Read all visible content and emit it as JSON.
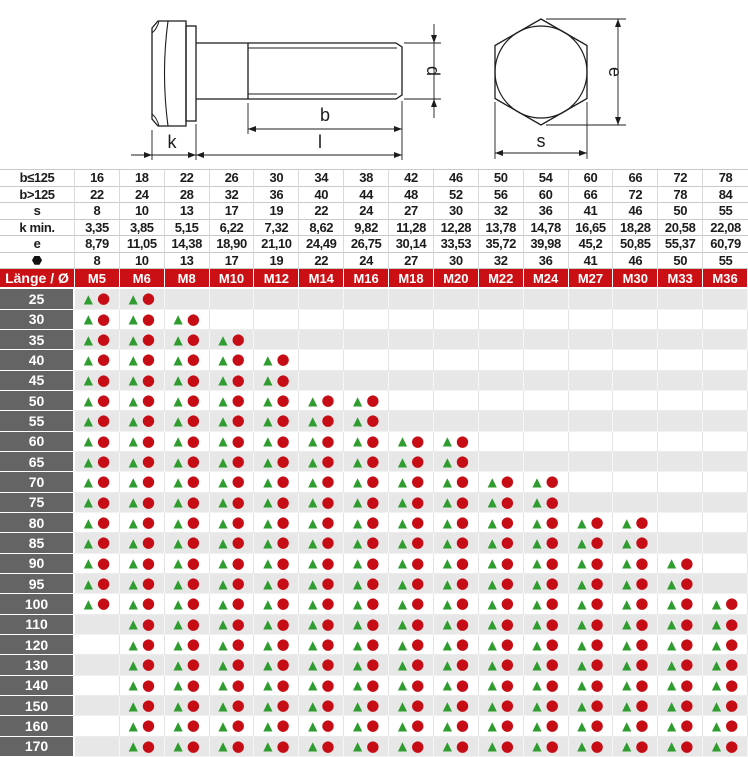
{
  "colors": {
    "header_red": "#cb1015",
    "label_gray": "#646464",
    "row_gray": "#e7e7e7",
    "tri_green": "#2f9c2f",
    "dot_red": "#c60d15",
    "drawing_line": "#1c1c1c"
  },
  "drawing": {
    "bolt_side_view": {
      "dim_labels": {
        "k": "k",
        "l": "l",
        "b": "b",
        "d": "d"
      }
    },
    "hex_head_view": {
      "dim_labels": {
        "e": "e",
        "s": "s"
      }
    }
  },
  "spec_table": {
    "rows": [
      {
        "label": "b≤125",
        "values": [
          "16",
          "18",
          "22",
          "26",
          "30",
          "34",
          "38",
          "42",
          "46",
          "50",
          "54",
          "60",
          "66",
          "72",
          "78"
        ]
      },
      {
        "label": "b>125",
        "values": [
          "22",
          "24",
          "28",
          "32",
          "36",
          "40",
          "44",
          "48",
          "52",
          "56",
          "60",
          "66",
          "72",
          "78",
          "84"
        ]
      },
      {
        "label": "s",
        "values": [
          "8",
          "10",
          "13",
          "17",
          "19",
          "22",
          "24",
          "27",
          "30",
          "32",
          "36",
          "41",
          "46",
          "50",
          "55"
        ]
      },
      {
        "label": "k min.",
        "values": [
          "3,35",
          "3,85",
          "5,15",
          "6,22",
          "7,32",
          "8,62",
          "9,82",
          "11,28",
          "12,28",
          "13,78",
          "14,78",
          "16,65",
          "18,28",
          "20,58",
          "22,08"
        ]
      },
      {
        "label": "e",
        "values": [
          "8,79",
          "11,05",
          "14,38",
          "18,90",
          "21,10",
          "24,49",
          "26,75",
          "30,14",
          "33,53",
          "35,72",
          "39,98",
          "45,2",
          "50,85",
          "55,37",
          "60,79"
        ]
      },
      {
        "label": "",
        "icon": "hexagon-icon",
        "values": [
          "8",
          "10",
          "13",
          "17",
          "19",
          "22",
          "24",
          "27",
          "30",
          "32",
          "36",
          "41",
          "46",
          "50",
          "55"
        ]
      }
    ]
  },
  "main_table": {
    "corner_header": "Länge / Ø",
    "columns": [
      "M5",
      "M6",
      "M8",
      "M10",
      "M12",
      "M14",
      "M16",
      "M18",
      "M20",
      "M22",
      "M24",
      "M27",
      "M30",
      "M33",
      "M36"
    ],
    "markers": {
      "triangle": "▲",
      "circle": "●"
    },
    "rows": [
      {
        "length": "25",
        "available": [
          "M5",
          "M6"
        ]
      },
      {
        "length": "30",
        "available": [
          "M5",
          "M6",
          "M8"
        ]
      },
      {
        "length": "35",
        "available": [
          "M5",
          "M6",
          "M8",
          "M10"
        ]
      },
      {
        "length": "40",
        "available": [
          "M5",
          "M6",
          "M8",
          "M10",
          "M12"
        ]
      },
      {
        "length": "45",
        "available": [
          "M5",
          "M6",
          "M8",
          "M10",
          "M12"
        ]
      },
      {
        "length": "50",
        "available": [
          "M5",
          "M6",
          "M8",
          "M10",
          "M12",
          "M14",
          "M16"
        ]
      },
      {
        "length": "55",
        "available": [
          "M5",
          "M6",
          "M8",
          "M10",
          "M12",
          "M14",
          "M16"
        ]
      },
      {
        "length": "60",
        "available": [
          "M5",
          "M6",
          "M8",
          "M10",
          "M12",
          "M14",
          "M16",
          "M18",
          "M20"
        ]
      },
      {
        "length": "65",
        "available": [
          "M5",
          "M6",
          "M8",
          "M10",
          "M12",
          "M14",
          "M16",
          "M18",
          "M20"
        ]
      },
      {
        "length": "70",
        "available": [
          "M5",
          "M6",
          "M8",
          "M10",
          "M12",
          "M14",
          "M16",
          "M18",
          "M20",
          "M22",
          "M24"
        ]
      },
      {
        "length": "75",
        "available": [
          "M5",
          "M6",
          "M8",
          "M10",
          "M12",
          "M14",
          "M16",
          "M18",
          "M20",
          "M22",
          "M24"
        ]
      },
      {
        "length": "80",
        "available": [
          "M5",
          "M6",
          "M8",
          "M10",
          "M12",
          "M14",
          "M16",
          "M18",
          "M20",
          "M22",
          "M24",
          "M27",
          "M30"
        ]
      },
      {
        "length": "85",
        "available": [
          "M5",
          "M6",
          "M8",
          "M10",
          "M12",
          "M14",
          "M16",
          "M18",
          "M20",
          "M22",
          "M24",
          "M27",
          "M30"
        ]
      },
      {
        "length": "90",
        "available": [
          "M5",
          "M6",
          "M8",
          "M10",
          "M12",
          "M14",
          "M16",
          "M18",
          "M20",
          "M22",
          "M24",
          "M27",
          "M30",
          "M33"
        ]
      },
      {
        "length": "95",
        "available": [
          "M5",
          "M6",
          "M8",
          "M10",
          "M12",
          "M14",
          "M16",
          "M18",
          "M20",
          "M22",
          "M24",
          "M27",
          "M30",
          "M33"
        ]
      },
      {
        "length": "100",
        "available": [
          "M5",
          "M6",
          "M8",
          "M10",
          "M12",
          "M14",
          "M16",
          "M18",
          "M20",
          "M22",
          "M24",
          "M27",
          "M30",
          "M33",
          "M36"
        ]
      },
      {
        "length": "110",
        "available": [
          "M6",
          "M8",
          "M10",
          "M12",
          "M14",
          "M16",
          "M18",
          "M20",
          "M22",
          "M24",
          "M27",
          "M30",
          "M33",
          "M36"
        ]
      },
      {
        "length": "120",
        "available": [
          "M6",
          "M8",
          "M10",
          "M12",
          "M14",
          "M16",
          "M18",
          "M20",
          "M22",
          "M24",
          "M27",
          "M30",
          "M33",
          "M36"
        ]
      },
      {
        "length": "130",
        "available": [
          "M6",
          "M8",
          "M10",
          "M12",
          "M14",
          "M16",
          "M18",
          "M20",
          "M22",
          "M24",
          "M27",
          "M30",
          "M33",
          "M36"
        ]
      },
      {
        "length": "140",
        "available": [
          "M6",
          "M8",
          "M10",
          "M12",
          "M14",
          "M16",
          "M18",
          "M20",
          "M22",
          "M24",
          "M27",
          "M30",
          "M33",
          "M36"
        ]
      },
      {
        "length": "150",
        "available": [
          "M6",
          "M8",
          "M10",
          "M12",
          "M14",
          "M16",
          "M18",
          "M20",
          "M22",
          "M24",
          "M27",
          "M30",
          "M33",
          "M36"
        ]
      },
      {
        "length": "160",
        "available": [
          "M6",
          "M8",
          "M10",
          "M12",
          "M14",
          "M16",
          "M18",
          "M20",
          "M22",
          "M24",
          "M27",
          "M30",
          "M33",
          "M36"
        ]
      },
      {
        "length": "170",
        "available": [
          "M6",
          "M8",
          "M10",
          "M12",
          "M14",
          "M16",
          "M18",
          "M20",
          "M22",
          "M24",
          "M27",
          "M30",
          "M33",
          "M36"
        ]
      }
    ]
  }
}
